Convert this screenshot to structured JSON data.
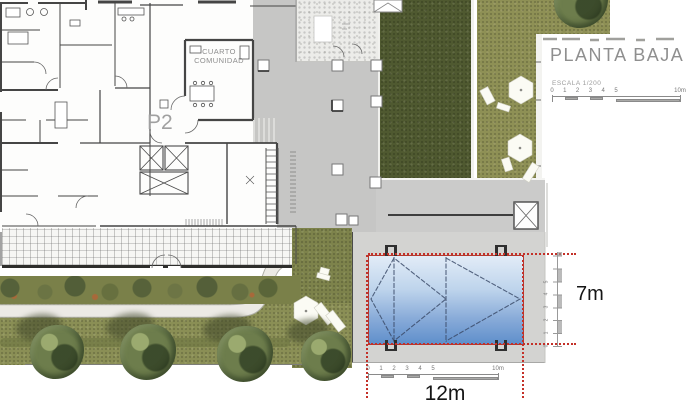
{
  "title_block": {
    "title": "PLANTA BAJA",
    "scale_label": "ESCALA 1/200",
    "ruler_ticks": [
      "0",
      "1",
      "2",
      "3",
      "4",
      "5"
    ],
    "ruler_end": "10m"
  },
  "floor_plan": {
    "room_label_line1": "CUARTO",
    "room_label_line2": "COMUNIDAD",
    "unit_label": "P2"
  },
  "pool": {
    "width_dim": "12m",
    "depth_dim": "7m",
    "bottom_ruler_ticks": [
      "0",
      "1",
      "2",
      "3",
      "4",
      "5"
    ],
    "bottom_ruler_end": "10m",
    "side_ruler_ticks": [
      "0",
      "1",
      "2",
      "3",
      "4",
      "5"
    ]
  },
  "colors": {
    "dimension_red": "#c43028",
    "pool_blue_top": "#e2ecf7",
    "pool_blue_bottom": "#5f8fcb",
    "grass_dark": "#4f5930",
    "grass_light": "#8e9055",
    "paving_gray": "#c6c6c5",
    "deck_gray": "#d3d3d1"
  }
}
